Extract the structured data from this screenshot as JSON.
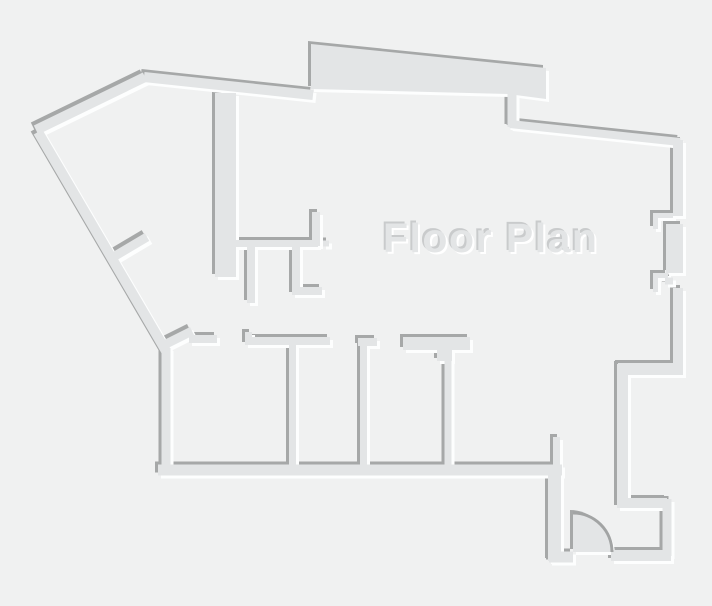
{
  "title": "Floor Plan",
  "colors": {
    "background": "#f0f1f1",
    "wall_fill": "#e3e5e6",
    "wall_shadow": "#a6a8a8",
    "wall_highlight": "#fdfefe",
    "door_arc": "#a2a4a4",
    "title_fill": "#e3e5e6",
    "title_shadow": "#c9cbcc",
    "title_highlight": "#ffffff"
  },
  "floor_plan": {
    "canvas": {
      "width": 712,
      "height": 606
    },
    "emboss": {
      "shadow_offset": 3,
      "highlight_offset": 3
    },
    "walls": [
      {
        "name": "outer-wall-nw-diagonal",
        "d": "M36,130 L145,77",
        "w": 10
      },
      {
        "name": "outer-wall-top",
        "d": "M144,77 L313,95",
        "w": 10
      },
      {
        "name": "top-connector-wall",
        "d": "M512,94 L512,127",
        "w": 9
      },
      {
        "name": "outer-wall-top-right",
        "d": "M510,124 L680,142",
        "w": 8
      },
      {
        "name": "right-wall-upper",
        "d": "M678,140 L678,216",
        "w": 10
      },
      {
        "name": "right-jamb-1-bar",
        "d": "M653,215.5 L673,215.5",
        "w": 5
      },
      {
        "name": "right-jamb-1-leg",
        "d": "M655.5,213 L655.5,229",
        "w": 5
      },
      {
        "name": "right-wall-mid",
        "d": "M674.5,224 L674.5,273",
        "w": 17
      },
      {
        "name": "right-jamb-2-bar",
        "d": "M653,275.5 L668,275.5",
        "w": 5
      },
      {
        "name": "right-jamb-2-leg",
        "d": "M655.5,273 L655.5,292",
        "w": 5
      },
      {
        "name": "right-jamb-2-block",
        "d": "M665,281 L673,281",
        "w": 7
      },
      {
        "name": "right-wall-lower",
        "d": "M678,288 L678,370",
        "w": 10
      },
      {
        "name": "right-step-top",
        "d": "M618,369 L683,369",
        "w": 12
      },
      {
        "name": "right-step-left",
        "d": "M622.5,364 L622.5,508",
        "w": 11
      },
      {
        "name": "alcove-bottom-wall",
        "d": "M628,503 L667,503",
        "w": 10
      },
      {
        "name": "alcove-right-wall",
        "d": "M667,499 L667,556",
        "w": 9
      },
      {
        "name": "entry-wall-right",
        "d": "M611,555.5 L671,555.5",
        "w": 11
      },
      {
        "name": "entry-jamb-foot",
        "d": "M549,557 L573,557",
        "w": 11
      },
      {
        "name": "entry-wall-left",
        "d": "M554.5,474 L554.5,561",
        "w": 13
      },
      {
        "name": "entry-stub-wall",
        "d": "M556.5,437 L556.5,476",
        "w": 7
      },
      {
        "name": "bottom-wall",
        "d": "M158,470 L562,470",
        "w": 11
      },
      {
        "name": "left-wall",
        "d": "M166,348 L166,475",
        "w": 9
      },
      {
        "name": "outer-wall-sw-diagonal",
        "d": "M38,132 L166,351",
        "w": 10
      },
      {
        "name": "core-wall",
        "d": "M225.5,93 L225.5,277",
        "w": 21
      },
      {
        "name": "left-diagonal-stub",
        "d": "M110,259 L147,237",
        "w": 9
      },
      {
        "name": "bath-wall-south",
        "d": "M236,243.5 L318,243.5",
        "w": 7
      },
      {
        "name": "bath-wall-riser",
        "d": "M316,212 L316,246",
        "w": 8
      },
      {
        "name": "bath-wall-cap",
        "d": "M323,243.5 L329,243.5",
        "w": 6
      },
      {
        "name": "bath-stub-left",
        "d": "M251,246 L251,303",
        "w": 8
      },
      {
        "name": "bath-stub-l-shape",
        "d": "M296,246 L296,291 L322,291",
        "w": 8
      },
      {
        "name": "corridor-step",
        "d": "M248.5,332 L248.5,340",
        "w": 7
      },
      {
        "name": "corridor-bar-1",
        "d": "M245,341 L330,341",
        "w": 8
      },
      {
        "name": "corridor-stub-left",
        "d": "M189,339 L217,339",
        "w": 8
      },
      {
        "name": "corridor-diagonal-stub",
        "d": "M160,347 L192,331",
        "w": 9
      },
      {
        "name": "partition-1",
        "d": "M292.5,341 L292.5,465",
        "w": 7
      },
      {
        "name": "corridor-bar-2",
        "d": "M358,342 L377,342",
        "w": 8
      },
      {
        "name": "partition-2",
        "d": "M363.5,342 L363.5,465",
        "w": 7
      },
      {
        "name": "corridor-bar-3",
        "d": "M403,343.5 L470,343.5",
        "w": 13
      },
      {
        "name": "corridor-bar-3-neck",
        "d": "M444.5,349 L444.5,361",
        "w": 15
      },
      {
        "name": "partition-3",
        "d": "M448,358 L448,465",
        "w": 7
      }
    ],
    "polygons": [
      {
        "name": "top-band-wall",
        "points": "311,44 546,68 546,99 508,94 311,89"
      }
    ],
    "door": {
      "name": "entry-door-swing",
      "pie_d": "M573,513 A39,39 0 0 1 612,552 L573,552 Z",
      "arc_d": "M573,513 A39,39 0 0 1 612,552",
      "arc_width": 3
    }
  }
}
